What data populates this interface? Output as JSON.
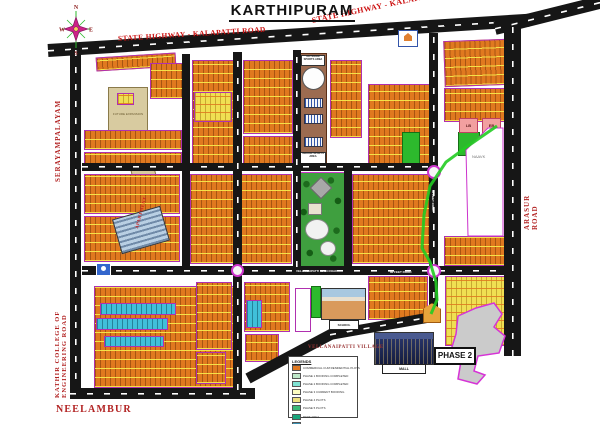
{
  "title": "KARTHIPURAM",
  "compass": {
    "north": "N",
    "east": "E",
    "south": "S",
    "west": "W"
  },
  "roads": {
    "highway_label_left": "STATE HIGHWAY - KALAPATTI ROAD",
    "highway_label_right": "STATE HIGHWAY - KALAPATTI ROAD",
    "serayampalayam": "SERAYAMPALAYAM",
    "kathir_college": "KATHIR COLLEGE OF  ENGINEERING ROAD",
    "neelambur": "NEELAMBUR",
    "arasur": "ARASUR ROAD",
    "mid_road_name": "VELLANAIPATTI MAIN ROAD",
    "cross_road_name": "80 FEET ROAD",
    "main_vertical_road_name": "60 FEET ROAD"
  },
  "areas": {
    "village": "VELLANAIPATTI VILLAGE",
    "naavk": "NAAVK",
    "future_expansion": "FUTURE EXPANSION",
    "outdoor_sports": "OUTDOOR SPORTS AREA",
    "indoor_sports": "INDOOR SPORTS AREA",
    "apartment": "APARTMENT",
    "lb": "LB",
    "eb": "EB"
  },
  "callouts": {
    "phase2": "PHASE 2",
    "mall": "MALL",
    "school": "SCHOOL"
  },
  "legend": {
    "title": "LEGENDS",
    "items": [
      {
        "color": "#e07820",
        "label": "COMMERCIAL CUM RESIDENTIAL PLOTS"
      },
      {
        "color": "#bfe8c9",
        "label": "PHASE 1 BOOKING COMPLETED"
      },
      {
        "color": "#7fe3d4",
        "label": "PHASE 2 BOOKING COMPLETED"
      },
      {
        "color": "#fdfdc0",
        "label": "PHASE 3 CURRENT BOOKING"
      },
      {
        "color": "#efe27e",
        "label": "PHASE 4 PLOTS"
      },
      {
        "color": "#3cb878",
        "label": "PHASE 5 PLOTS"
      },
      {
        "color": "#19a57c",
        "label": "PARK AREA"
      },
      {
        "color": "#3a8fb0",
        "label": "COMMERCIAL AREA"
      }
    ]
  },
  "colors": {
    "road": "#161616",
    "plot_orange": "#e0791f",
    "plot_yellow": "#f0df52",
    "plot_cyan": "#40c0da",
    "park_green": "#3f9f3f",
    "stream_green": "#22cc22",
    "boundary_magenta": "#cc33cc",
    "label_red": "#b22222",
    "phase2_gray": "#cbcbcb"
  }
}
